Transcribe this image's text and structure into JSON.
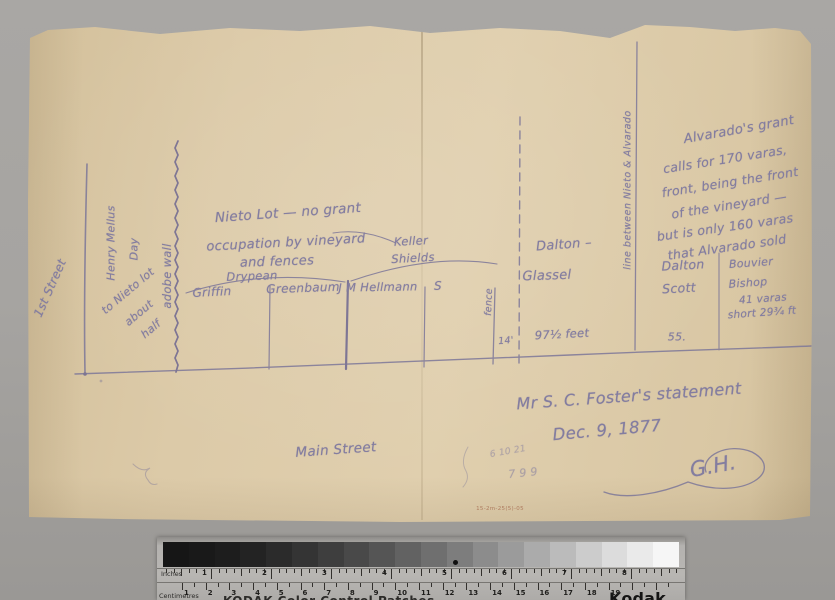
{
  "colors": {
    "pencil": "#7d7799",
    "pencil_dark": "#6e6791",
    "paper": "#dccaa8",
    "background": "#a6a4a1",
    "red_annotation": "#a56a4e"
  },
  "sketch": {
    "first_street": "1st Street",
    "henry_mellus": "Henry Mellus",
    "day": "Day",
    "nieto_half_1": "to Nieto lot",
    "nieto_half_2": "about",
    "nieto_half_3": "half",
    "adobe_wall": "adobe wall",
    "nieto_title_1": "Nieto Lot — no grant",
    "nieto_title_2": "occupation by vineyard",
    "nieto_title_3": "and fences",
    "drypean": "Drypean",
    "griffin": "Griffin",
    "greenbaum": "Greenbaum",
    "hellman": "J M Hellmann",
    "keller": "Keller",
    "shields": "Shields",
    "s_label": "S",
    "fence": "fence",
    "fourteen_feet": "14'",
    "dalton_dash": "Dalton –",
    "glassel": "Glassel",
    "feet_97": "97½ feet",
    "boundary_line": "line between Nieto & Alvarado",
    "alvarado_1": "Alvarado's grant",
    "alvarado_2": "calls for 170 varas,",
    "alvarado_3": "front, being the front",
    "alvarado_4": "of the vineyard —",
    "alvarado_5": "but is only 160 varas",
    "alvarado_6": "that Alvarado sold",
    "dalton": "Dalton",
    "scott": "Scott",
    "fifty_five": "55.",
    "bouvier": "Bouvier",
    "bishop": "Bishop",
    "varas_41": "41 varas",
    "short_note": "short 29¾ ft",
    "statement_line1": "Mr S. C. Foster's statement",
    "statement_line2": "Dec. 9, 1877",
    "signature": "G.H.",
    "scribble_1": "6 10 21",
    "scribble_2": "7 9 9",
    "main_street": "Main Street",
    "tiny_red_mark": "15-2m-25(5)-05"
  },
  "ruler": {
    "inches_label": "Inches",
    "cm_label": "Centimetres",
    "brand": "Kodak",
    "patches_text": "KODAK Color Control Patches",
    "inch_numbers": [
      "1",
      "2",
      "3",
      "4",
      "5",
      "6",
      "7",
      "8"
    ],
    "cm_numbers": [
      "1",
      "2",
      "3",
      "4",
      "5",
      "6",
      "7",
      "8",
      "9",
      "10",
      "11",
      "12",
      "13",
      "14",
      "15",
      "16",
      "17",
      "18",
      "19"
    ],
    "grayscale_steps": [
      "#161616",
      "#191919",
      "#1d1d1d",
      "#232323",
      "#2b2b2b",
      "#343434",
      "#3e3e3e",
      "#494949",
      "#555555",
      "#626262",
      "#6f6f6f",
      "#7d7d7d",
      "#8c8c8c",
      "#9b9b9b",
      "#ababab",
      "#bbbbbb",
      "#cccccc",
      "#dcdcdc",
      "#eaeaea",
      "#f6f6f6"
    ]
  }
}
